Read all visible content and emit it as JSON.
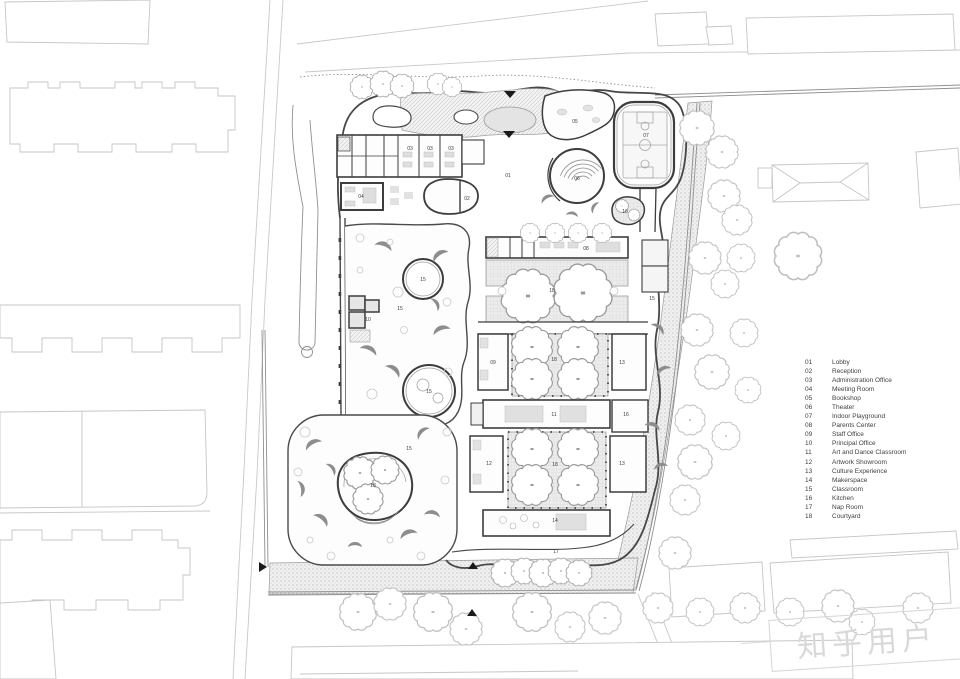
{
  "title": "Kindergarten Site Plan",
  "colors": {
    "wall": "#3d3d3d",
    "context_line": "#c8c8c8",
    "fence": "#8f8f8f",
    "paving_grid": "#ececec",
    "gravel": "#f0f0f0",
    "shrub": "#8d8d8d",
    "watermark": "#d9d9d9"
  },
  "legend": {
    "items": [
      {
        "num": "01",
        "label": "Lobby"
      },
      {
        "num": "02",
        "label": "Reception"
      },
      {
        "num": "03",
        "label": "Administration Office"
      },
      {
        "num": "04",
        "label": "Meeting Room"
      },
      {
        "num": "05",
        "label": "Bookshop"
      },
      {
        "num": "06",
        "label": "Theater"
      },
      {
        "num": "07",
        "label": "Indoor Playground"
      },
      {
        "num": "08",
        "label": "Parents Center"
      },
      {
        "num": "09",
        "label": "Staff Office"
      },
      {
        "num": "10",
        "label": "Principal Office"
      },
      {
        "num": "11",
        "label": "Art and Dance Classroom"
      },
      {
        "num": "12",
        "label": "Artwork Showroom"
      },
      {
        "num": "13",
        "label": "Culture Experience"
      },
      {
        "num": "14",
        "label": "Makerspace"
      },
      {
        "num": "15",
        "label": "Classroom"
      },
      {
        "num": "16",
        "label": "Kitchen"
      },
      {
        "num": "17",
        "label": "Nap Room"
      },
      {
        "num": "18",
        "label": "Courtyard"
      }
    ]
  },
  "plan_labels": [
    {
      "num": "01"
    },
    {
      "num": "02"
    },
    {
      "num": "03"
    },
    {
      "num": "03"
    },
    {
      "num": "03"
    },
    {
      "num": "04"
    },
    {
      "num": "05"
    },
    {
      "num": "06"
    },
    {
      "num": "07"
    },
    {
      "num": "08"
    },
    {
      "num": "09"
    },
    {
      "num": "10"
    },
    {
      "num": "11"
    },
    {
      "num": "12"
    },
    {
      "num": "13"
    },
    {
      "num": "13"
    },
    {
      "num": "14"
    },
    {
      "num": "15"
    },
    {
      "num": "15"
    },
    {
      "num": "15"
    },
    {
      "num": "15"
    },
    {
      "num": "15"
    },
    {
      "num": "16"
    },
    {
      "num": "17"
    },
    {
      "num": "18"
    },
    {
      "num": "18"
    },
    {
      "num": "18"
    },
    {
      "num": "18"
    },
    {
      "num": "18"
    }
  ],
  "watermark": {
    "text": "知乎用户"
  }
}
